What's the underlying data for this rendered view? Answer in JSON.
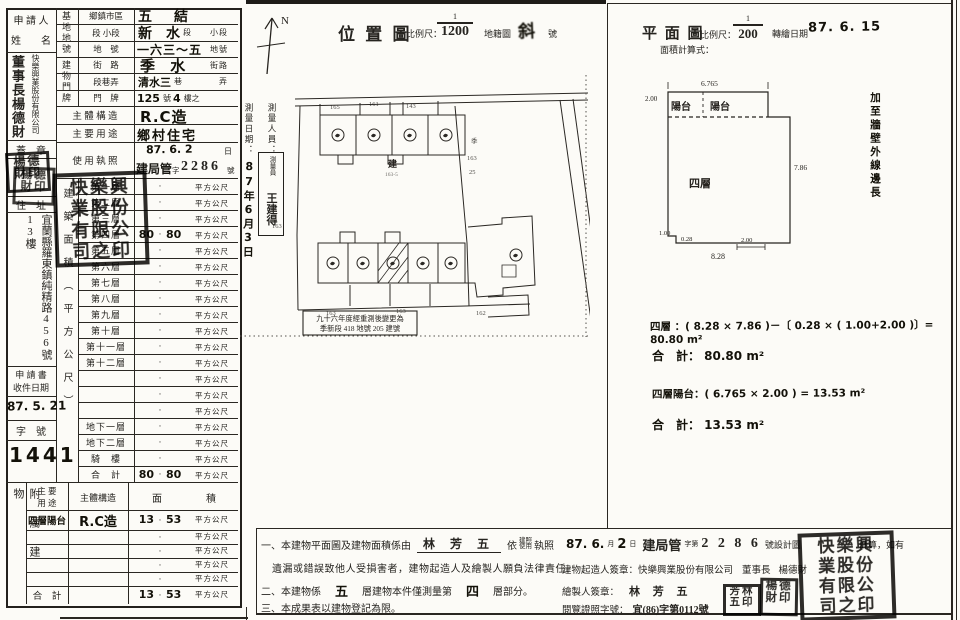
{
  "form": {
    "applicant_label_1": "申 請 人",
    "applicant_label_2": "姓　　名",
    "applicant_title_name": "董事長楊德財",
    "applicant_company": "快樂興業股份有限公司",
    "seal_label": "蓋　章",
    "address_label": "住　址",
    "address": "宜蘭縣羅東鎮純精路456號13樓",
    "receipt_label_1": "申 請 書",
    "receipt_label_2": "收件日期",
    "receipt_date": "87. 5. 21",
    "docket_label": "字　號",
    "docket_no": "1441",
    "site_section": "基地地號",
    "bldg_section": "建物門牌",
    "rows": [
      {
        "label": "鄉鎮市區",
        "value": "五　結",
        "mid": "",
        "suffix": ""
      },
      {
        "label": "段 小段",
        "value": "新　水",
        "mid": "段",
        "suffix": "小段"
      },
      {
        "label": "地　號",
        "value": "一六三～五",
        "mid": "",
        "suffix": "地號"
      },
      {
        "label": "街　路",
        "value": "季 水",
        "mid": "",
        "suffix": "街路"
      },
      {
        "label": "段巷弄",
        "value": "清水三",
        "mid": "巷",
        "suffix": "弄"
      },
      {
        "label": "門　牌",
        "value": "125",
        "mid": "號",
        "value2": "4",
        "suffix": "樓之"
      }
    ],
    "structure_label": "主 體 構 造",
    "structure_value": "R.C造",
    "usage_label": "主 要 用 途",
    "usage_value": "鄉村住宅",
    "license_label": "使 用 執 照",
    "license_date": "87. 6. 2",
    "license_date_suffix": "日",
    "license_no_1": "建局管",
    "license_no_2": "字",
    "license_no_3": "2286",
    "license_no_4": "號",
    "area_section": "建築面積（平方公尺）",
    "unit": "平方公尺",
    "dot": "·",
    "floor_rows": [
      {
        "f": "第一層",
        "l": "",
        "r": ""
      },
      {
        "f": "第二層",
        "l": "",
        "r": ""
      },
      {
        "f": "第三層",
        "l": "",
        "r": ""
      },
      {
        "f": "第四層",
        "l": "80",
        "r": "80"
      },
      {
        "f": "第五層",
        "l": "",
        "r": ""
      },
      {
        "f": "第六層",
        "l": "",
        "r": ""
      },
      {
        "f": "第七層",
        "l": "",
        "r": ""
      },
      {
        "f": "第八層",
        "l": "",
        "r": ""
      },
      {
        "f": "第九層",
        "l": "",
        "r": ""
      },
      {
        "f": "第十層",
        "l": "",
        "r": ""
      },
      {
        "f": "第十一層",
        "l": "",
        "r": ""
      },
      {
        "f": "第十二層",
        "l": "",
        "r": ""
      },
      {
        "f": "",
        "l": "",
        "r": ""
      },
      {
        "f": "",
        "l": "",
        "r": ""
      },
      {
        "f": "",
        "l": "",
        "r": ""
      },
      {
        "f": "地下一層",
        "l": "",
        "r": ""
      },
      {
        "f": "地下二層",
        "l": "",
        "r": ""
      },
      {
        "f": "騎　樓",
        "l": "",
        "r": ""
      },
      {
        "f": "合　計",
        "l": "80",
        "r": "80"
      }
    ],
    "annex_section": "附屬建物",
    "annex_header": {
      "use1": "主 要",
      "use2": "用 途",
      "structure": "主體構造",
      "area1": "面",
      "area2": "積"
    },
    "annex_rows": [
      {
        "u": "四層陽台",
        "s": "R.C造",
        "l": "13",
        "r": "53"
      },
      {
        "u": "",
        "s": "",
        "l": "",
        "r": ""
      },
      {
        "u": "",
        "s": "",
        "l": "",
        "r": ""
      },
      {
        "u": "",
        "s": "",
        "l": "",
        "r": ""
      },
      {
        "u": "",
        "s": "",
        "l": "",
        "r": ""
      },
      {
        "u": "合　計",
        "s": "",
        "l": "13",
        "r": "53"
      }
    ]
  },
  "survey": {
    "staff_label": "測量人員：",
    "staff_prefix": "測量員",
    "staff_name": "王建得",
    "date_label": "測量日期：",
    "date": "87年6月3日"
  },
  "location_map": {
    "title": "位 置 圖",
    "scale_label": "比例尺：",
    "scale_num": "1",
    "scale_den": "1200",
    "cadastre_label": "地籍圖",
    "cadastre_value": "斜",
    "cadastre_suffix": "號",
    "north": "N",
    "center_mark": "建",
    "center_parcel": "163-5",
    "stamp_line1": "九十六年度經重測後變更為",
    "stamp_line2": "季新段 418 地號 205 建號",
    "ann": [
      "165",
      "161",
      "143",
      "163",
      "163",
      "163",
      "162",
      "季",
      "163",
      "25"
    ]
  },
  "floor_plan": {
    "title": "平 面 圖",
    "scale_label": "比例尺：",
    "scale_num": "1",
    "scale_den": "200",
    "redraw_label": "轉繪日期",
    "redraw_date": "87. 6. 15",
    "calc_label": "面積計算式：",
    "balcony1": "陽台",
    "balcony2": "陽台",
    "floor": "四層",
    "side_note": "加至牆壁外線邊長",
    "dims": {
      "top": "6.765",
      "left": "2.00",
      "right": "7.86",
      "bottom": "8.28",
      "notch_w": "1.00",
      "notch_h": "0.28",
      "seg": "2.00"
    },
    "calc1": "四層 ：( 8.28 × 7.86 )－〔 0.28 × ( 1.00+2.00 )〕= 80.80 m²",
    "total1": "合　計： 80.80 m²",
    "calc2": "四層陽台：( 6.765 × 2.00 ) = 13.53 m²",
    "total2": "合　計： 13.53 m²"
  },
  "notes": {
    "l1a": "一、本建物平面圖及建物面積係由",
    "l1_name": "林 芳 五",
    "l1b": "依",
    "l1_lic1": "建照",
    "l1_lic2": "使用",
    "l1c": "執照",
    "l1_date": "87. 6.",
    "l1_month": "月",
    "l1_day": "2",
    "l1_day_suffix": "日",
    "l1_bureau": "建局管",
    "l1d": "字第",
    "l1_no": "2 2 8 6",
    "l1e": "號設計圖",
    "l1f": "計算，如有",
    "l2": "遺漏或錯誤致他人受損害者，建物起造人及繪製人願負法律責任。",
    "l3a": "二、本建物係",
    "l3_n1": "五",
    "l3b": "層建物本件僅測量第",
    "l3_n2": "四",
    "l3c": "層部分。",
    "l4": "三、本成果表以建物登記為限。",
    "builder_label": "建物起造人簽章：",
    "builder_company": "快樂興業股份有限公司",
    "builder_title": "董事長",
    "builder_name": "楊德財",
    "drafter_label": "繪製人簽章：",
    "drafter_name": "林 芳 五",
    "view_license_label": "閱覽證照字號：",
    "view_license_no": "宜(86)字第0112號"
  },
  "stamps": {
    "owner_row1": "楊德",
    "owner_row2": "財印",
    "company_row1": "快樂興",
    "company_row2": "業股份",
    "company_row3": "有限公",
    "company_row4": "司之印",
    "drafter_row1": "芳林",
    "drafter_row2": "五印"
  }
}
